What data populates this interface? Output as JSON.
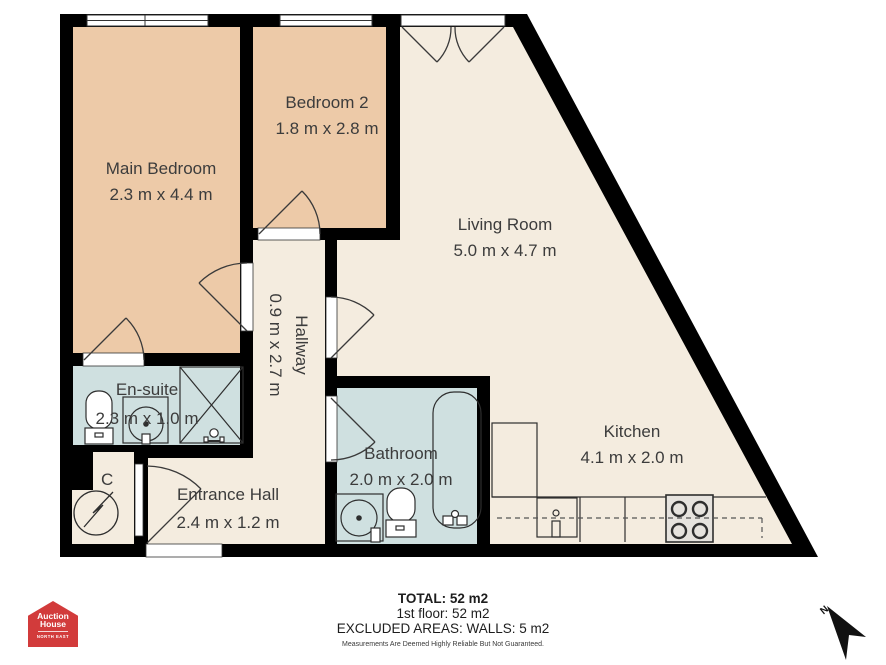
{
  "colors": {
    "wall": "#000000",
    "bedroom_fill": "#edcaa8",
    "living_fill": "#f4ecdf",
    "wet_room_fill": "#cfe0e0",
    "logo_red": "#d23b3b"
  },
  "rooms": {
    "main_bedroom": {
      "name": "Main Bedroom",
      "dims": "2.3 m x 4.4 m"
    },
    "bedroom2": {
      "name": "Bedroom 2",
      "dims": "1.8 m x 2.8 m"
    },
    "living_room": {
      "name": "Living Room",
      "dims": "5.0 m x 4.7 m"
    },
    "hallway": {
      "name": "Hallway",
      "dims": "0.9 m x 2.7 m"
    },
    "ensuite": {
      "name": "En-suite",
      "dims": "2.3 m x 1.0 m"
    },
    "bathroom": {
      "name": "Bathroom",
      "dims": "2.0 m x 2.0 m"
    },
    "entrance_hall": {
      "name": "Entrance Hall",
      "dims": "2.4 m x 1.2 m"
    },
    "kitchen": {
      "name": "Kitchen",
      "dims": "4.1 m x 2.0 m"
    },
    "closet": {
      "name": "C"
    }
  },
  "summary": {
    "total": "TOTAL: 52 m2",
    "floor": "1st floor: 52 m2",
    "excluded": "EXCLUDED AREAS: WALLS: 5 m2",
    "disclaimer": "Measurements Are Deemed Highly Reliable But Not Guaranteed."
  },
  "logo": {
    "line1": "Auction",
    "line2": "House",
    "region": "NORTH EAST"
  },
  "compass": {
    "north": "N"
  }
}
